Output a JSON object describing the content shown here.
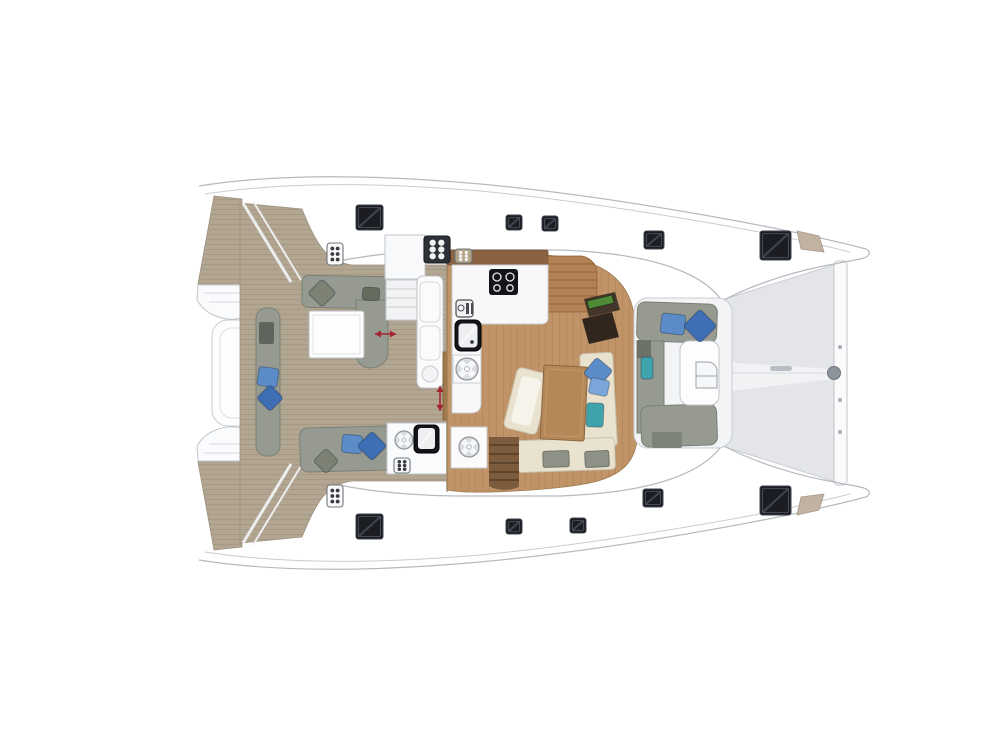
{
  "colors": {
    "outline": "#b6bac0",
    "deck_soft": "#f3f4f6",
    "teak": "#b2a692",
    "teak_stripe": "#9c9078",
    "floor": "#c09468",
    "floor_stripe": "#a87e50",
    "walnut": "#8a6242",
    "stairs_wood": "#b28254",
    "stairs_wood_line": "#8d6338",
    "stairs_lower": "#7d5c3e",
    "stairs_lower_line": "#4e3722",
    "sofa": "#969a91",
    "sofa_dark": "#6d7268",
    "seat_cream": "#e9e2cf",
    "seat_pad": "#f6f3ea",
    "cushion_gray": "#8d9186",
    "blue": "#5b8cc8",
    "blue_dark": "#3e6fb4",
    "blue_light": "#7aa6da",
    "teal": "#3fa3ac",
    "olive": "#7c8173",
    "olive_dark": "#666b5e",
    "white_furniture": "#fdfdfe",
    "galley": "#f8f8f9",
    "appliance": "#121418",
    "table_wood": "#b5885a",
    "table_wood_line": "#8a6540",
    "chart_desk": "#44352a",
    "chart_desk_dark": "#30261d",
    "chart_green": "#4f8a38",
    "tramp": "#e3e5e9",
    "tramp_walk": "#f1f2f4",
    "hatch": "#1b1d22",
    "hatch_sheen": "#454b57",
    "arrow": "#a32430",
    "anchor_tan": "#c2b2a2",
    "fitting_gray": "#8d939b",
    "door_wood": "#a07a4e"
  },
  "fixtures": {
    "hatches": [
      {
        "x": 356,
        "y": 205,
        "w": 27,
        "h": 25
      },
      {
        "x": 506,
        "y": 215,
        "w": 16,
        "h": 15
      },
      {
        "x": 542,
        "y": 216,
        "w": 16,
        "h": 15
      },
      {
        "x": 644,
        "y": 231,
        "w": 20,
        "h": 18
      },
      {
        "x": 760,
        "y": 231,
        "w": 31,
        "h": 29
      },
      {
        "x": 356,
        "y": 514,
        "w": 27,
        "h": 25
      },
      {
        "x": 506,
        "y": 519,
        "w": 16,
        "h": 15
      },
      {
        "x": 570,
        "y": 518,
        "w": 16,
        "h": 15
      },
      {
        "x": 643,
        "y": 489,
        "w": 20,
        "h": 18
      },
      {
        "x": 760,
        "y": 486,
        "w": 31,
        "h": 29
      }
    ],
    "panels": [
      {
        "x": 327,
        "y": 243,
        "w": 16,
        "h": 22,
        "style": "light"
      },
      {
        "x": 327,
        "y": 485,
        "w": 16,
        "h": 22,
        "style": "light"
      },
      {
        "x": 394,
        "y": 458,
        "w": 16,
        "h": 15,
        "style": "light"
      },
      {
        "x": 455,
        "y": 249,
        "w": 17,
        "h": 14,
        "style": "tan"
      },
      {
        "x": 424,
        "y": 236,
        "w": 26,
        "h": 27,
        "style": "dark"
      }
    ],
    "wheels": [
      {
        "cx": 467,
        "cy": 369,
        "r": 11,
        "pad": [
          453,
          355,
          28,
          28
        ]
      },
      {
        "cx": 469,
        "cy": 447,
        "r": 10,
        "pad": [
          451,
          427,
          36,
          41
        ]
      },
      {
        "cx": 404,
        "cy": 440,
        "r": 9,
        "pad": null
      }
    ],
    "pillows": [
      {
        "cx": 673,
        "cy": 324,
        "w": 24,
        "h": 20,
        "rot": 6,
        "color": "blue"
      },
      {
        "cx": 700,
        "cy": 326,
        "w": 24,
        "h": 24,
        "rot": 45,
        "color": "blue_dark"
      },
      {
        "cx": 647,
        "cy": 368,
        "w": 12,
        "h": 22,
        "rot": 0,
        "color": "teal"
      },
      {
        "cx": 268,
        "cy": 377,
        "w": 20,
        "h": 19,
        "rot": 8,
        "color": "blue"
      },
      {
        "cx": 270,
        "cy": 398,
        "w": 19,
        "h": 19,
        "rot": 45,
        "color": "blue_dark"
      },
      {
        "cx": 322,
        "cy": 293,
        "w": 20,
        "h": 20,
        "rot": 45,
        "color": "olive"
      },
      {
        "cx": 371,
        "cy": 294,
        "w": 17,
        "h": 13,
        "rot": 3,
        "color": "olive_dark"
      },
      {
        "cx": 352,
        "cy": 444,
        "w": 20,
        "h": 18,
        "rot": 5,
        "color": "blue"
      },
      {
        "cx": 372,
        "cy": 446,
        "w": 21,
        "h": 21,
        "rot": 45,
        "color": "blue_dark"
      },
      {
        "cx": 326,
        "cy": 461,
        "w": 18,
        "h": 18,
        "rot": 45,
        "color": "olive"
      },
      {
        "cx": 598,
        "cy": 372,
        "w": 21,
        "h": 21,
        "rot": 40,
        "color": "blue"
      },
      {
        "cx": 599,
        "cy": 387,
        "w": 19,
        "h": 16,
        "rot": 12,
        "color": "blue_light"
      },
      {
        "cx": 595,
        "cy": 415,
        "w": 17,
        "h": 24,
        "rot": 2,
        "color": "teal"
      }
    ],
    "arrows": [
      {
        "x1": 375,
        "y1": 334,
        "x2": 396,
        "y2": 334
      },
      {
        "x1": 440,
        "y1": 386,
        "x2": 440,
        "y2": 411
      }
    ],
    "beam_dots": [
      {
        "cx": 840,
        "cy": 347
      },
      {
        "cx": 840,
        "cy": 400
      },
      {
        "cx": 840,
        "cy": 432
      }
    ]
  }
}
